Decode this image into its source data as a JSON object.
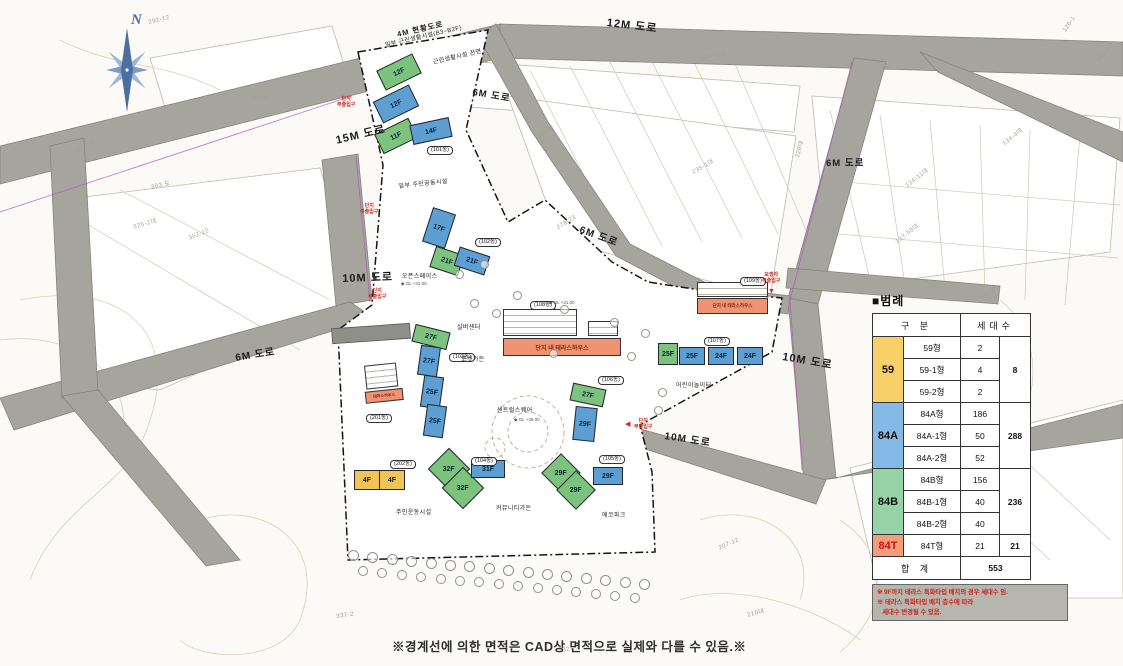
{
  "compass": {
    "label": "N"
  },
  "colors": {
    "blue": "#5d9fd3",
    "green": "#7cc37e",
    "yellow": "#f2c455",
    "orange": "#ef9372",
    "road": "#a5a59d",
    "legend_yellow": "#f7d06a",
    "legend_blue": "#85b9e6",
    "legend_green": "#97d3a6",
    "legend_salmon": "#f49d7c"
  },
  "road_labels": [
    {
      "text": "12M 도로",
      "x": 608,
      "y": 14,
      "rot": 7,
      "size": 11
    },
    {
      "text": "15M 도로",
      "x": 334,
      "y": 132,
      "rot": -13,
      "size": 11
    },
    {
      "text": "4M 현황도로",
      "x": 396,
      "y": 29,
      "rot": -13,
      "size": 7.5
    },
    {
      "text": "6M 도로",
      "x": 474,
      "y": 84,
      "rot": 10,
      "size": 9.5
    },
    {
      "text": "6M 도로",
      "x": 583,
      "y": 221,
      "rot": 20,
      "size": 10
    },
    {
      "text": "6M 도로",
      "x": 826,
      "y": 155,
      "rot": 0,
      "size": 9.5
    },
    {
      "text": "6M 도로",
      "x": 234,
      "y": 349,
      "rot": -9,
      "size": 10
    },
    {
      "text": "10M 도로",
      "x": 342,
      "y": 270,
      "rot": -2,
      "size": 11
    },
    {
      "text": "10M 도로",
      "x": 784,
      "y": 348,
      "rot": 10,
      "size": 11
    },
    {
      "text": "10M 도로",
      "x": 666,
      "y": 427,
      "rot": 9,
      "size": 10
    }
  ],
  "buildings": [
    {
      "f": "12F",
      "x": 399,
      "y": 72,
      "w": 40,
      "h": 22,
      "r": -26,
      "c": "green"
    },
    {
      "f": "12F",
      "x": 396,
      "y": 104,
      "w": 40,
      "h": 24,
      "r": -26,
      "c": "blue"
    },
    {
      "f": "11F",
      "x": 396,
      "y": 136,
      "w": 38,
      "h": 22,
      "r": -26,
      "c": "green"
    },
    {
      "f": "14F",
      "x": 431,
      "y": 131,
      "w": 40,
      "h": 20,
      "r": -12,
      "c": "blue"
    },
    {
      "f": "17F",
      "x": 439,
      "y": 228,
      "w": 24,
      "h": 36,
      "r": 18,
      "c": "blue"
    },
    {
      "f": "21F",
      "x": 447,
      "y": 261,
      "w": 30,
      "h": 22,
      "r": 18,
      "c": "green"
    },
    {
      "f": "21F",
      "x": 472,
      "y": 261,
      "w": 32,
      "h": 20,
      "r": 18,
      "c": "blue"
    },
    {
      "f": "27F",
      "x": 431,
      "y": 337,
      "w": 36,
      "h": 18,
      "r": 14,
      "c": "green"
    },
    {
      "f": "27F",
      "x": 429,
      "y": 361,
      "w": 20,
      "h": 30,
      "r": 8,
      "c": "blue"
    },
    {
      "f": "25F",
      "x": 432,
      "y": 392,
      "w": 20,
      "h": 32,
      "r": 8,
      "c": "blue"
    },
    {
      "f": "25F",
      "x": 435,
      "y": 421,
      "w": 20,
      "h": 32,
      "r": 8,
      "c": "blue"
    },
    {
      "f": "32F",
      "x": 449,
      "y": 469,
      "w": 30,
      "h": 30,
      "r": 45,
      "c": "green"
    },
    {
      "f": "32F",
      "x": 463,
      "y": 488,
      "w": 30,
      "h": 30,
      "r": 45,
      "c": "green"
    },
    {
      "f": "31F",
      "x": 488,
      "y": 469,
      "w": 34,
      "h": 18,
      "r": 0,
      "c": "blue"
    },
    {
      "f": "27F",
      "x": 588,
      "y": 395,
      "w": 34,
      "h": 18,
      "r": 12,
      "c": "green"
    },
    {
      "f": "29F",
      "x": 585,
      "y": 424,
      "w": 22,
      "h": 34,
      "r": 6,
      "c": "blue"
    },
    {
      "f": "29F",
      "x": 561,
      "y": 473,
      "w": 28,
      "h": 28,
      "r": 45,
      "c": "green"
    },
    {
      "f": "29F",
      "x": 576,
      "y": 490,
      "w": 28,
      "h": 28,
      "r": 45,
      "c": "green"
    },
    {
      "f": "29F",
      "x": 608,
      "y": 476,
      "w": 30,
      "h": 18,
      "r": 0,
      "c": "blue"
    },
    {
      "f": "25F",
      "x": 668,
      "y": 354,
      "w": 20,
      "h": 22,
      "r": 0,
      "c": "green"
    },
    {
      "f": "25F",
      "x": 692,
      "y": 356,
      "w": 26,
      "h": 18,
      "r": 0,
      "c": "blue"
    },
    {
      "f": "24F",
      "x": 721,
      "y": 356,
      "w": 26,
      "h": 18,
      "r": 0,
      "c": "blue"
    },
    {
      "f": "24F",
      "x": 750,
      "y": 356,
      "w": 26,
      "h": 18,
      "r": 0,
      "c": "blue"
    },
    {
      "f": "4F",
      "x": 367,
      "y": 480,
      "w": 26,
      "h": 20,
      "r": 0,
      "c": "yellow",
      "flat": true
    },
    {
      "f": "4F",
      "x": 392,
      "y": 480,
      "w": 26,
      "h": 20,
      "r": 0,
      "c": "yellow",
      "flat": true
    }
  ],
  "dong_labels": [
    {
      "text": "(101동)",
      "x": 427,
      "y": 146
    },
    {
      "text": "(102동)",
      "x": 475,
      "y": 238
    },
    {
      "text": "(103동)",
      "x": 449,
      "y": 353
    },
    {
      "text": "(104동)",
      "x": 471,
      "y": 457
    },
    {
      "text": "(105동)",
      "x": 599,
      "y": 455
    },
    {
      "text": "(106동)",
      "x": 598,
      "y": 376
    },
    {
      "text": "(107동)",
      "x": 704,
      "y": 337
    },
    {
      "text": "(108동)",
      "x": 530,
      "y": 301
    },
    {
      "text": "(109동)",
      "x": 740,
      "y": 277
    },
    {
      "text": "(201동)",
      "x": 366,
      "y": 414
    },
    {
      "text": "(202동)",
      "x": 390,
      "y": 460
    }
  ],
  "terrace_blocks": [
    {
      "label": "단지 내 테라스하우스",
      "x": 503,
      "y": 295,
      "w": 118,
      "stackA": [
        0,
        14,
        74,
        27
      ],
      "stackB": [
        85,
        26,
        30,
        15
      ],
      "band": [
        0,
        43,
        118,
        18
      ],
      "fs": 6
    },
    {
      "label": "단지 내 테라스하우스",
      "x": 697,
      "y": 282,
      "w": 71,
      "stackA": [
        0,
        0,
        71,
        15
      ],
      "stackB": null,
      "band": [
        0,
        16,
        71,
        16
      ],
      "fs": 4.5
    },
    {
      "label": "테라스하우스",
      "x": 362,
      "y": 366,
      "w": 40,
      "stackA": [
        2,
        0,
        32,
        24
      ],
      "stackB": null,
      "band": [
        0,
        26,
        38,
        12
      ],
      "fs": 4,
      "rot": -6
    }
  ],
  "facilities": [
    {
      "text": "실버센터",
      "x": 457,
      "y": 322,
      "rot": 0
    },
    {
      "text": "포켓가든",
      "x": 461,
      "y": 354,
      "rot": 0
    },
    {
      "text": "센트럴스퀘어",
      "x": 497,
      "y": 405,
      "rot": 0
    },
    {
      "text": "오픈스페이스",
      "x": 402,
      "y": 271,
      "rot": 0
    },
    {
      "text": "일부 주민공동시설",
      "x": 398,
      "y": 181,
      "rot": -6
    },
    {
      "text": "일부 근린생활시설(B3~B2F)",
      "x": 384,
      "y": 40,
      "rot": -13
    },
    {
      "text": "근린생활시설 전면",
      "x": 432,
      "y": 57,
      "rot": -13
    },
    {
      "text": "주민운동시설",
      "x": 396,
      "y": 507,
      "rot": 0
    },
    {
      "text": "커뮤니티가든",
      "x": 496,
      "y": 503,
      "rot": 0
    },
    {
      "text": "에코파크",
      "x": 602,
      "y": 510,
      "rot": 0
    },
    {
      "text": "어린이놀이터",
      "x": 676,
      "y": 380,
      "rot": 0
    }
  ],
  "entrances": [
    {
      "line1": "단지",
      "line2": "부출입구",
      "x": 337,
      "y": 96
    },
    {
      "line1": "단지",
      "line2": "주출입구",
      "x": 360,
      "y": 203
    },
    {
      "line1": "단지",
      "line2": "부출입구",
      "x": 368,
      "y": 288
    },
    {
      "line1": "보행자",
      "line2": "부출입구",
      "x": 762,
      "y": 272
    },
    {
      "line1": "단지",
      "line2": "부출입구",
      "x": 634,
      "y": 418
    }
  ],
  "gl_marks": [
    {
      "text": "◆ GL +46.00",
      "x": 514,
      "y": 417
    },
    {
      "text": "◆ GL +31.00",
      "x": 549,
      "y": 300
    },
    {
      "text": "◆ GL +31.00",
      "x": 401,
      "y": 281
    }
  ],
  "parcel_numbers": [
    {
      "text": "291-12",
      "x": 148,
      "y": 20,
      "rot": -14
    },
    {
      "text": "298대",
      "x": 250,
      "y": 94,
      "rot": -8
    },
    {
      "text": "287-7대",
      "x": 702,
      "y": 52,
      "rot": -8
    },
    {
      "text": "235-1대",
      "x": 690,
      "y": 168,
      "rot": -30
    },
    {
      "text": "278-23",
      "x": 556,
      "y": 226,
      "rot": -32
    },
    {
      "text": "274대",
      "x": 536,
      "y": 132,
      "rot": -32
    },
    {
      "text": "303 도",
      "x": 150,
      "y": 182,
      "rot": -12
    },
    {
      "text": "310-1도",
      "x": 72,
      "y": 148,
      "rot": -30
    },
    {
      "text": "325-2대",
      "x": 132,
      "y": 222,
      "rot": -16
    },
    {
      "text": "302-12",
      "x": 188,
      "y": 236,
      "rot": -22
    },
    {
      "text": "134-11대",
      "x": 903,
      "y": 182,
      "rot": -38
    },
    {
      "text": "137-50대",
      "x": 893,
      "y": 238,
      "rot": -38
    },
    {
      "text": "134-4대",
      "x": 1000,
      "y": 140,
      "rot": -38
    },
    {
      "text": "141-40",
      "x": 978,
      "y": 296,
      "rot": -28
    },
    {
      "text": "220대",
      "x": 792,
      "y": 156,
      "rot": -75
    },
    {
      "text": "207-12",
      "x": 718,
      "y": 546,
      "rot": -24
    },
    {
      "text": "210대",
      "x": 746,
      "y": 610,
      "rot": -14
    },
    {
      "text": "327-2",
      "x": 562,
      "y": 648,
      "rot": -12
    },
    {
      "text": "337-2",
      "x": 336,
      "y": 614,
      "rot": -8
    },
    {
      "text": "126-1",
      "x": 1062,
      "y": 30,
      "rot": -55
    },
    {
      "text": "131-4",
      "x": 1096,
      "y": 60,
      "rot": -55
    }
  ],
  "legend": {
    "title": "■범례",
    "col_headers": [
      "구 분",
      "세대수"
    ],
    "groups": [
      {
        "code": "59",
        "color": "#f7d06a",
        "code_color": "#111",
        "rows": [
          [
            "59형",
            "2"
          ],
          [
            "59-1형",
            "4"
          ],
          [
            "59-2형",
            "2"
          ]
        ],
        "total": "8"
      },
      {
        "code": "84A",
        "color": "#85b9e6",
        "code_color": "#111",
        "rows": [
          [
            "84A형",
            "186"
          ],
          [
            "84A-1형",
            "50"
          ],
          [
            "84A-2형",
            "52"
          ]
        ],
        "total": "288"
      },
      {
        "code": "84B",
        "color": "#97d3a6",
        "code_color": "#111",
        "rows": [
          [
            "84B형",
            "156"
          ],
          [
            "84B-1형",
            "40"
          ],
          [
            "84B-2형",
            "40"
          ]
        ],
        "total": "236"
      },
      {
        "code": "84T",
        "color": "#f49d7c",
        "code_color": "#cc1111",
        "rows": [
          [
            "84T형",
            "21"
          ]
        ],
        "total": "21"
      }
    ],
    "total_row": {
      "label": "합 계",
      "value": "553"
    },
    "notes": [
      "※ 9F까지 테라스 특화타입 배치의 경우 세대수 임.",
      "※ 테라스 특화타입 배치 층수에 따라",
      "&nbsp;&nbsp;&nbsp;세대수 변경될 수 있음."
    ]
  },
  "bottom_note": "※경계선에 의한 면적은 CAD상 면적으로 실제와 다를 수 있음.※"
}
